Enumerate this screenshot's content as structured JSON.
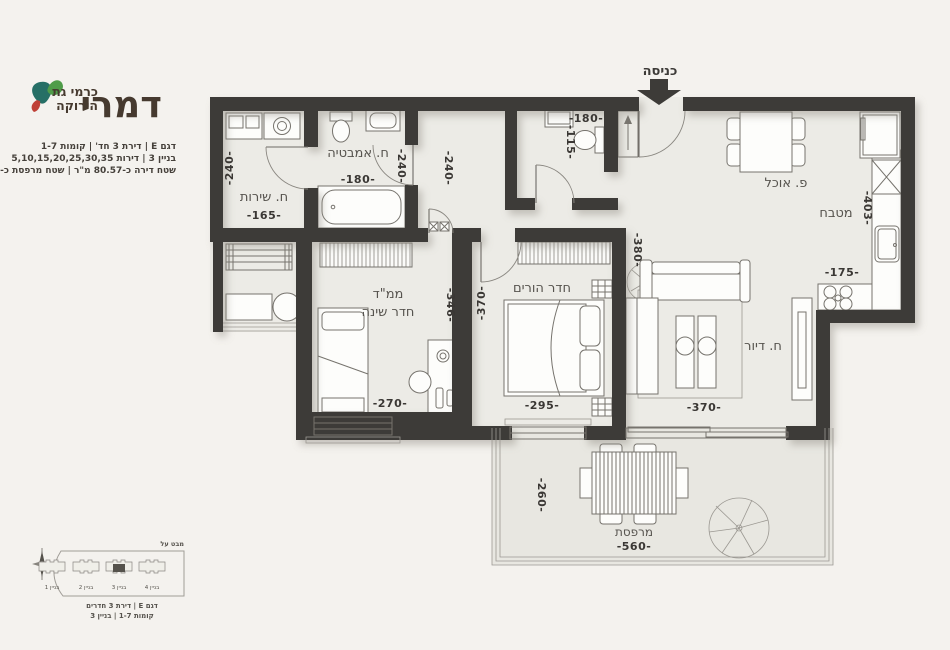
{
  "brand": {
    "name": "דמרי",
    "tagline_line1": "כרמי גת",
    "tagline_line2": "הירוקה"
  },
  "project_info": {
    "line1": "דגם E | דירת 3 חד' | קומות 1-7",
    "line2": "בניין 3 | דירות 5,10,15,20,25,30,35",
    "line3": "שטח דירה כ-80.57 מ\"ר | שטח מרפסת כ-14.56 מ\"ר"
  },
  "plan": {
    "entrance_label": "כניסה",
    "rooms": {
      "service": {
        "name": "ח. שירות",
        "width": "-165-",
        "height": "-240-"
      },
      "bathroom": {
        "name": "ח. אמבטיה",
        "width": "-180-",
        "height": "-240-"
      },
      "wc": {
        "width": "-180-",
        "height": "-115-"
      },
      "corridor": {
        "height": "-240-"
      },
      "mamad": {
        "name_line1": "ממ\"ד",
        "name_line2": "חדר שינה",
        "width": "-270-",
        "height": "-346-"
      },
      "master": {
        "name": "חדר הורים",
        "width": "-295-",
        "height_left": "-370-",
        "height_right": "-380-"
      },
      "living": {
        "name": "ח. דיור",
        "width": "-370-"
      },
      "kitchen": {
        "name": "מטבח",
        "width": "-175-",
        "height": "-403-"
      },
      "dining": {
        "name": "פ. אוכל"
      },
      "balcony": {
        "name": "מרפסת",
        "width": "-560-",
        "height": "-260-"
      }
    }
  },
  "site_plan": {
    "view_label": "מבט על",
    "buildings": [
      "בניין 1",
      "בניין 2",
      "בניין 3",
      "בניין 4"
    ],
    "caption_line1": "דגם E | דירת 3 חדרים",
    "caption_line2": "קומות 1-7 | בניין 3"
  },
  "colors": {
    "page_bg": "#f4f2ee",
    "wall": "#3d3b38",
    "floor": "#ecebe6",
    "balcony_floor": "#e8e7e1",
    "logo_teal": "#266f66",
    "logo_green": "#4f9c49",
    "logo_red": "#bf4036",
    "text_dark": "#3a3734"
  }
}
